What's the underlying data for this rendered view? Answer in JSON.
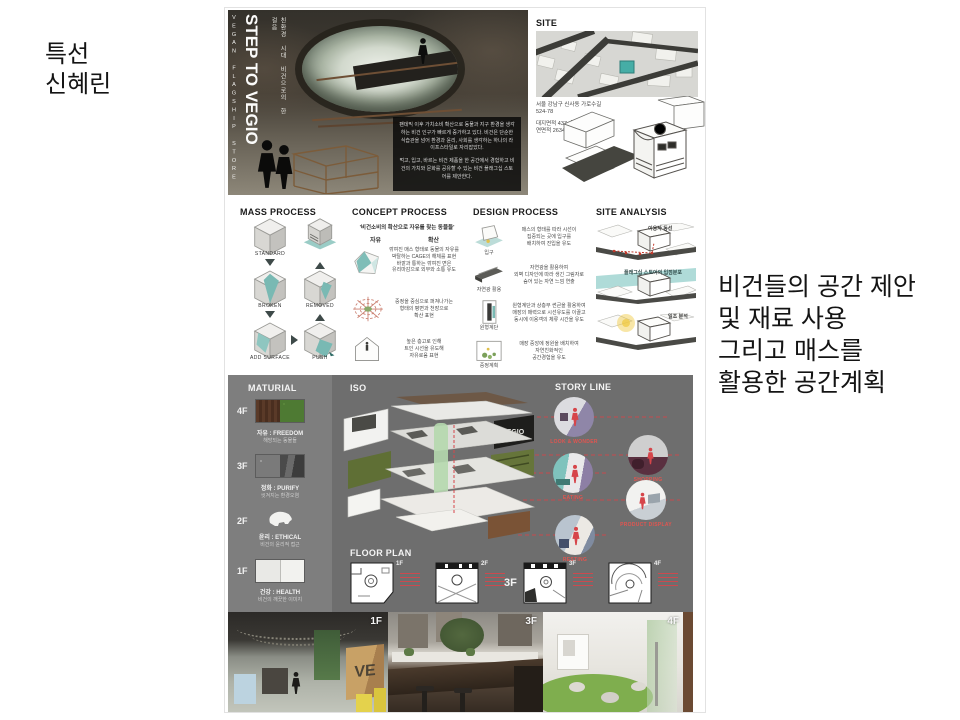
{
  "slide": {
    "award_lines": [
      "특선",
      "신혜린"
    ],
    "caption_lines": [
      "비건들의 공간 제안",
      "및 재료 사용",
      "그리고 매스를",
      "활용한 공간계획"
    ]
  },
  "hero": {
    "side_label": "VEGAN FLAGSHIP STORE",
    "title": "STEP TO VEGIO",
    "subtitle": "친환경 시대 비건으로의 한 걸음",
    "body_p1": "팬데믹 이후 가치소비 확산으로 동물과 지구 환경을 생각하는 비건 인구가 빠르게 증가하고 있다. 비건은 단순한 식습관을 넘어 환경과 윤리, 사회를 생각하는 하나의 라이프스타일로 자리잡았다.",
    "body_p2": "먹고, 입고, 바르는 비건 제품을 한 공간에서 경험하고 비건의 가치와 문화를 공유할 수 있는 비건 플래그십 스토어를 제안한다."
  },
  "site": {
    "label": "SITE",
    "info_lines": [
      "서울 강남구 신사동 가로수길",
      "524-78",
      "대지면적 437㎡  약 132평",
      "연면적 2634㎡"
    ]
  },
  "mass": {
    "title": "MASS PROCESS",
    "labels": [
      "STANDARD",
      "BROKEN",
      "REMOVED",
      "ADD SURFACE",
      "PUSH"
    ]
  },
  "concept": {
    "title": "CONCEPT PROCESS",
    "quote": "'비건소비의 확산으로 자유를 찾는 동물들'",
    "keywords": [
      "자유",
      "확산"
    ],
    "rows": [
      {
        "caption": "깎여진 매스 형태로 동물의 자유를\n박탈하는 CAGE의 해체를 표현\n바깥과 통하는 깎여진 면은\n유리마감으로 외부와 소통 유도"
      },
      {
        "caption": "중정을 중심으로 퍼져나가는\n형태의 평면과 천장으로\n확산 표현"
      },
      {
        "caption": "높은 층고로 인해\n트인 시선을 유도해\n자유로움 표현"
      }
    ]
  },
  "design": {
    "title": "DESIGN PROCESS",
    "rows": [
      {
        "label": "입구",
        "caption": "매스의 형태를 따라 시선이\n집중되는 곳에 입구를\n배치하여 진입을 유도"
      },
      {
        "label": "자연광 활용",
        "caption": "자연광을 활용하여\n외벽 디자인에 따라 생긴 그림자로\n숨어 있는 자연 느낌 연출"
      },
      {
        "label": "원형계단",
        "caption": "원형계단과 상층부 썬큰을 활용하여\n매장의 매력으로 시선유도를 이끌고\n동시에 이용객의 체류 시간을 유도"
      },
      {
        "label": "중정계획",
        "caption": "매장 중앙에 정원을 배치하여\n자연친화적인\n공간경험을 유도"
      }
    ]
  },
  "site_analysis": {
    "title": "SITE ANALYSIS",
    "items": [
      "이용자 동선",
      "플래그십 스토어의 입점분포",
      "일조 분석"
    ]
  },
  "material": {
    "title": "MATURIAL",
    "floors": [
      {
        "floor": "4F",
        "title": "자유 : FREEDOM",
        "sub": "해방되는 동물들"
      },
      {
        "floor": "3F",
        "title": "정화 : PURIFY",
        "sub": "씻겨지는 환경오염"
      },
      {
        "floor": "2F",
        "title": "윤리 : ETHICAL",
        "sub": "비건의 윤리적 접근"
      },
      {
        "floor": "1F",
        "title": "건강 : HEALTH",
        "sub": "비건의 깨끗한 이미지"
      }
    ]
  },
  "iso": {
    "label": "ISO",
    "logo": "VEGIO"
  },
  "storyline": {
    "title": "STORY LINE",
    "scenes": [
      "LOOK & WONDER",
      "SHOPPING",
      "EATING",
      "PRODUCT DISPLAY",
      "RESTING"
    ]
  },
  "floorplan": {
    "title": "FLOOR PLAN",
    "labels": [
      "1F",
      "2F",
      "3F",
      "4F"
    ],
    "highlight": "3F"
  },
  "renders": {
    "sign": "VE",
    "panels": [
      {
        "label": "1F"
      },
      {
        "label": "3F"
      },
      {
        "label": "4F"
      }
    ]
  },
  "colors": {
    "teal": "#74b8b2",
    "red": "#d6454a",
    "gray_band": "#6e6e6e",
    "material_col": "#7e7e7e"
  }
}
